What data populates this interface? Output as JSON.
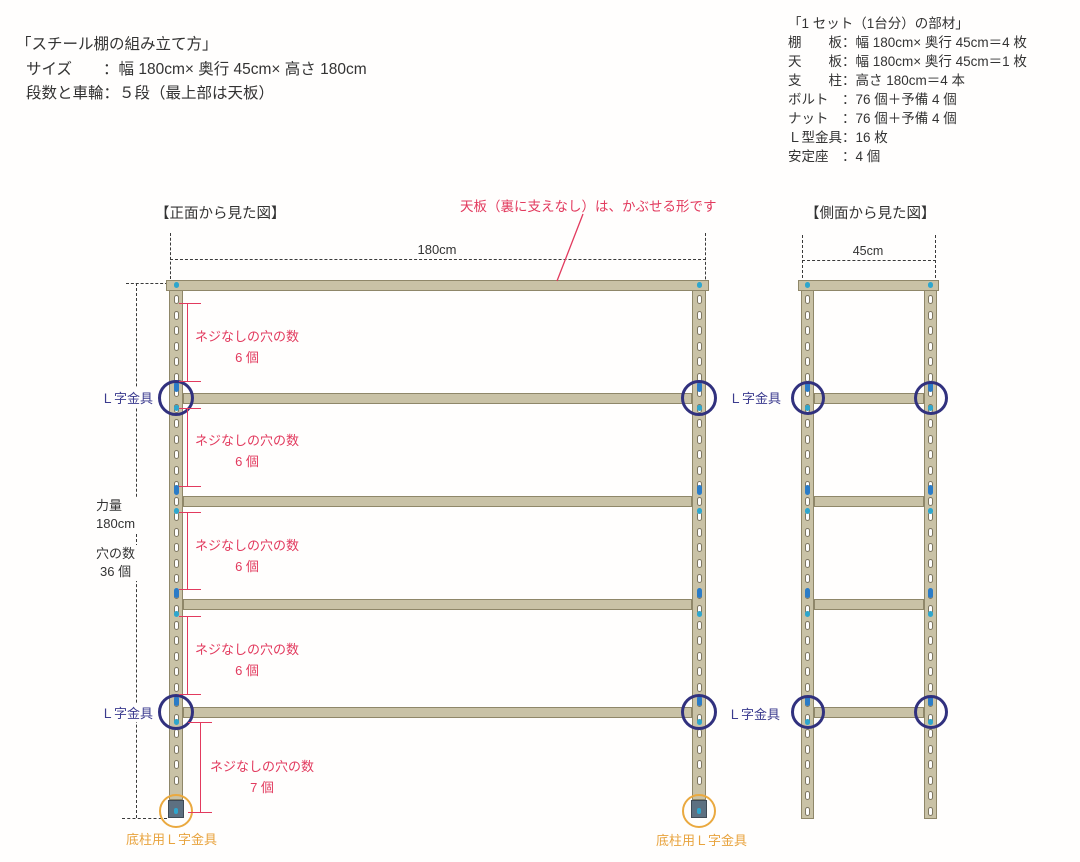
{
  "header": {
    "title": "「スチール棚の組み立て方」",
    "size_line": "サイズ　　：幅 180cm× 奥行 45cm× 高さ 180cm",
    "tiers_line": "段数と車輪：５段（最上部は天板）"
  },
  "parts": {
    "title": "「1 セット（1台分）の部材」",
    "items": [
      "棚　　板：幅 180cm× 奥行 45cm＝4 枚",
      "天　　板：幅 180cm× 奥行 45cm＝1 枚",
      "支　　柱：高さ 180cm＝4 本",
      "ボルト　：76 個＋予備 4 個",
      "ナット　：76 個＋予備 4 個",
      "Ｌ型金具：16 枚",
      "安定座　：4 個"
    ]
  },
  "front_view": {
    "heading": "【正面から見た図】",
    "width_label": "180cm"
  },
  "side_view": {
    "heading": "【側面から見た図】",
    "width_label": "45cm"
  },
  "dim_left": {
    "line1": "力量",
    "line2": "180cm",
    "line3": "穴の数",
    "line4": "36 個"
  },
  "annotations": {
    "top_note": "天板（裏に支えなし）は、かぶせる形です",
    "hole_note_line1": "ネジなしの穴の数",
    "hole_counts": [
      "6 個",
      "6 個",
      "6 個",
      "6 個",
      "7 個"
    ],
    "l_bracket": "Ｌ字金具",
    "bottom_bracket": "底柱用Ｌ字金具"
  },
  "diagram": {
    "colors": {
      "steel": "#c9c2a6",
      "steelBorder": "#8f8769",
      "slotBorder": "#7d7661",
      "navy": "#31317e",
      "cyan": "#2ea6cd",
      "blue": "#2b7cc7",
      "red": "#e23a5e",
      "orange": "#eaa93f",
      "foot": "#5d7081",
      "footBorder": "#3f4a55",
      "dash": "#3a3a3a"
    },
    "slots": {
      "w": 5,
      "h": 9,
      "pitch": 15.5,
      "start": 12
    },
    "front": {
      "posts": [
        {
          "x": 169,
          "y": 283,
          "w": 14,
          "h": 517,
          "foot": true
        },
        {
          "x": 692,
          "y": 283,
          "w": 14,
          "h": 517,
          "foot": true
        }
      ],
      "top_board": {
        "x": 166,
        "y": 280,
        "w": 543,
        "h": 11
      },
      "shelf_x": 183,
      "shelf_w": 509,
      "shelf_h": 11,
      "shelf_ys": [
        393,
        496,
        599,
        707
      ],
      "circle_shelf_ys": [
        393,
        707
      ],
      "circle_r": 18,
      "feet_y": 800,
      "feet_h": 18,
      "foot_circle_r": 17,
      "foot_circle_cy": 811
    },
    "side": {
      "posts": [
        {
          "x": 801,
          "y": 283,
          "w": 13,
          "h": 536,
          "foot": false
        },
        {
          "x": 924,
          "y": 283,
          "w": 13,
          "h": 536,
          "foot": false
        }
      ],
      "top_board": {
        "x": 798,
        "y": 280,
        "w": 141,
        "h": 11
      },
      "shelf_x": 814,
      "shelf_w": 110,
      "shelf_h": 11,
      "shelf_ys": [
        393,
        496,
        599,
        707
      ],
      "circle_shelf_ys": [
        393,
        707
      ],
      "circle_r": 17
    },
    "dashes": {
      "h": [
        {
          "x": 170,
          "y": 259,
          "w": 536,
          "name": "front-width-dim-line"
        },
        {
          "x": 126,
          "y": 283,
          "w": 42,
          "name": "height-dim-top-tick"
        },
        {
          "x": 122,
          "y": 818,
          "w": 45,
          "name": "height-dim-bottom-tick"
        },
        {
          "x": 802,
          "y": 260,
          "w": 134,
          "name": "side-width-dim-line"
        }
      ],
      "v": [
        {
          "x": 170,
          "y": 233,
          "h": 46,
          "name": "front-dim-ext-left"
        },
        {
          "x": 705,
          "y": 233,
          "h": 56,
          "name": "front-dim-ext-right"
        },
        {
          "x": 136,
          "y": 283,
          "h": 535,
          "name": "height-dim-line"
        },
        {
          "x": 802,
          "y": 235,
          "h": 53,
          "name": "side-dim-ext-left"
        },
        {
          "x": 935,
          "y": 235,
          "h": 53,
          "name": "side-dim-ext-right"
        }
      ]
    },
    "brackets": [
      {
        "lineX": 187,
        "top": 303,
        "bottom": 381,
        "tickX": 179,
        "tickW": 22,
        "textX": 247,
        "textTop": 326
      },
      {
        "lineX": 187,
        "top": 408,
        "bottom": 486,
        "tickX": 179,
        "tickW": 22,
        "textX": 247,
        "textTop": 430
      },
      {
        "lineX": 187,
        "top": 512,
        "bottom": 589,
        "tickX": 179,
        "tickW": 22,
        "textX": 247,
        "textTop": 535
      },
      {
        "lineX": 187,
        "top": 616,
        "bottom": 694,
        "tickX": 179,
        "tickW": 22,
        "textX": 247,
        "textTop": 639
      },
      {
        "lineX": 200,
        "top": 722,
        "bottom": 812,
        "tickX": 188,
        "tickW": 24,
        "textX": 262,
        "textTop": 756
      }
    ]
  }
}
